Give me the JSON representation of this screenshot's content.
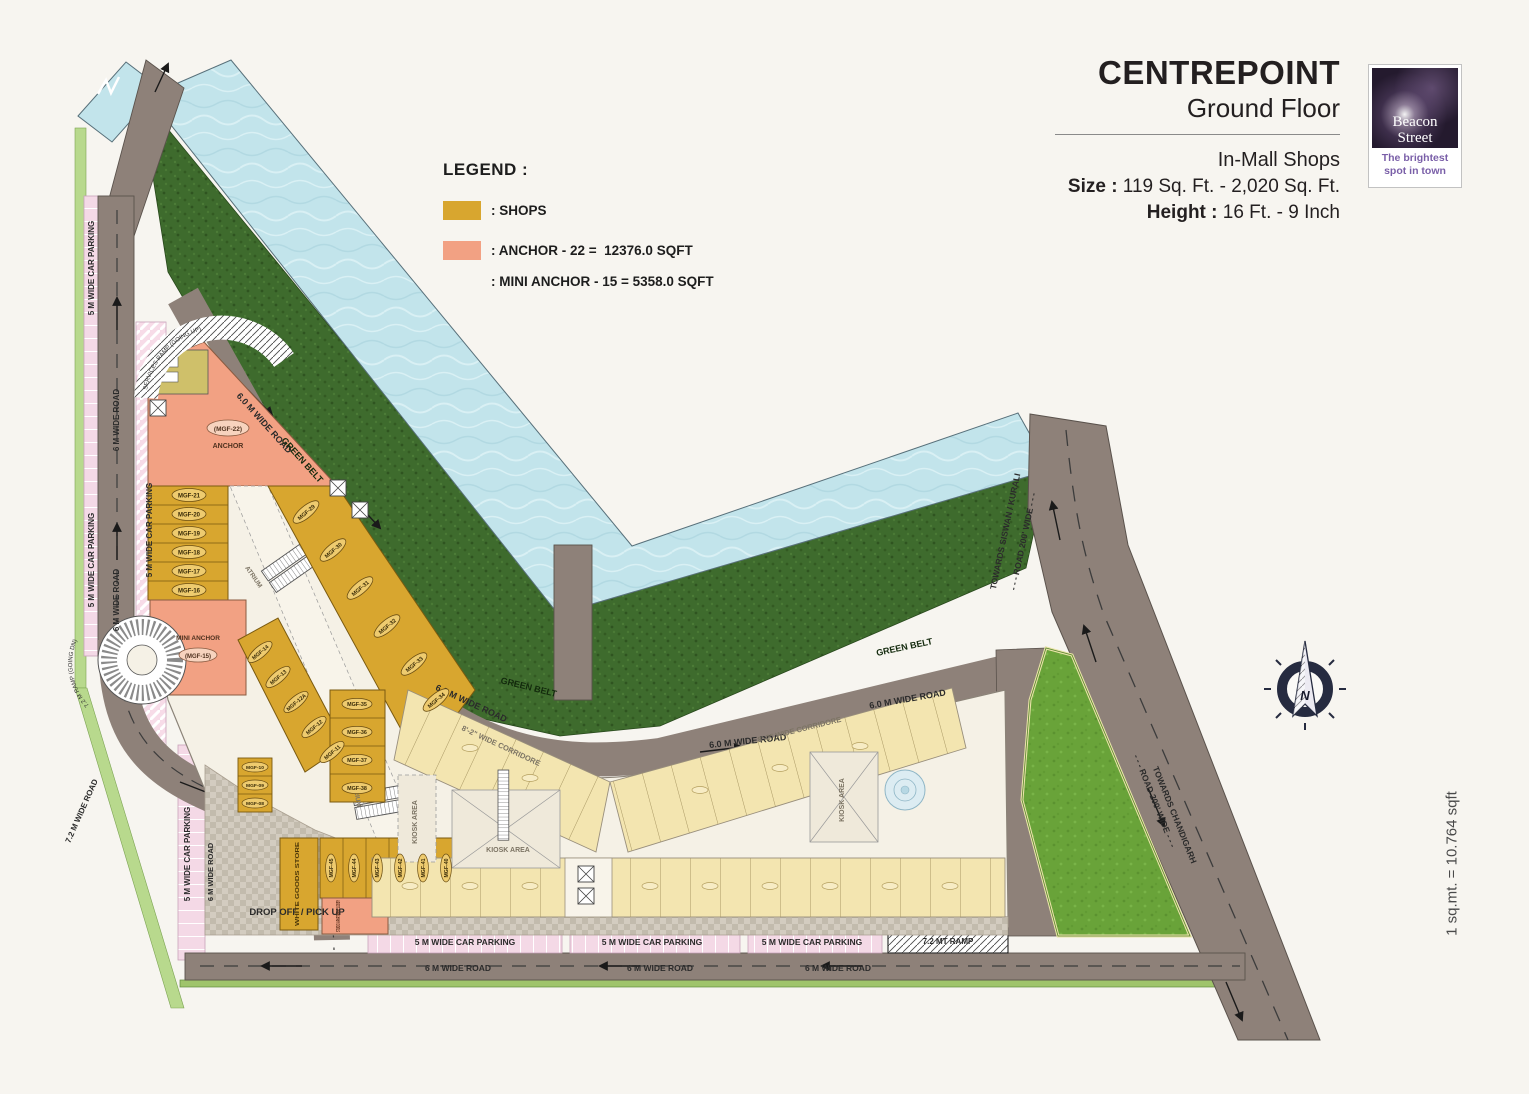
{
  "title_block": {
    "title": "CENTREPOINT",
    "subtitle": "Ground Floor",
    "category": "In-Mall Shops",
    "size_label": "Size : ",
    "size_value": "119 Sq. Ft. - 2,020 Sq. Ft.",
    "height_label": "Height : ",
    "height_value": "16 Ft. - 9 Inch"
  },
  "logo": {
    "brand_line1": "Beacon",
    "brand_line2": "Street",
    "tagline_line1": "The brightest",
    "tagline_line2": "spot in town"
  },
  "legend": {
    "heading": "LEGEND :",
    "shops_label": ": SHOPS",
    "anchor_label": ": ANCHOR - 22 =  12376.0 SQFT",
    "mini_anchor_label": ": MINI ANCHOR - 15 = 5358.0 SQFT",
    "shops_color": "#d8a62f",
    "anchor_color": "#f2a183"
  },
  "scale_note": "1 sq.mt. = 10.764 sqft",
  "compass": {
    "north_label": "N"
  },
  "plan": {
    "labels": {
      "car_parking_5m": "5 M WIDE CAR PARKING",
      "road_6m": "6 M WIDE ROAD",
      "road_6_0m": "6.0 M WIDE ROAD",
      "road_7_2m": "7.2 M WIDE ROAD",
      "ramp_7_2mt": "7.2 MT RAMP",
      "ramp_going_dn": "7.2 M RAMP (GOING DN)",
      "services_ramp": "SERVICES RAMP (GOING UP)",
      "green_belt": "GREEN BELT",
      "corridor_8ft2": "8'-2\" WIDE CORRIDORE",
      "kiosk_area": "KIOSK AREA",
      "atrium": "ATRIUM",
      "drop_off": "DROP OFF / PICK UP",
      "road_200_wide": "- - - ROAD 200' WIDE - - -",
      "towards_siswan": "TOWARDS SISWAN / KURALI",
      "towards_chandigarh": "TOWARDS CHANDIGARH"
    },
    "units": {
      "anchor_id": "(MGF-22)",
      "anchor_label": "ANCHOR",
      "mini_anchor_label": "MINI ANCHOR",
      "mini_anchor_id": "(MGF-15)",
      "studio_lobby": "STUDIO APARTMENT LOBBY",
      "white_goods": "WHITE GOODS STORE",
      "left_column": [
        "MGF-21",
        "MGF-20",
        "MGF-19",
        "MGF-18",
        "MGF-17",
        "MGF-16"
      ],
      "upper_diagonal": [
        "MGF-29",
        "MGF-30",
        "MGF-31",
        "MGF-32",
        "MGF-33",
        "MGF-34"
      ],
      "mid_diagonal": [
        "MGF-14",
        "MGF-13",
        "MGF-12A",
        "MGF-12",
        "MGF-11"
      ],
      "lower_left_column": [
        "MGF-10",
        "MGF-09",
        "MGF-08"
      ],
      "right_column": [
        "MGF-35",
        "MGF-36",
        "MGF-37",
        "MGF-38"
      ],
      "bottom_row": [
        "MGF-45",
        "MGF-44",
        "MGF-43",
        "MGF-42",
        "MGF-41",
        "MGF-40"
      ]
    }
  }
}
